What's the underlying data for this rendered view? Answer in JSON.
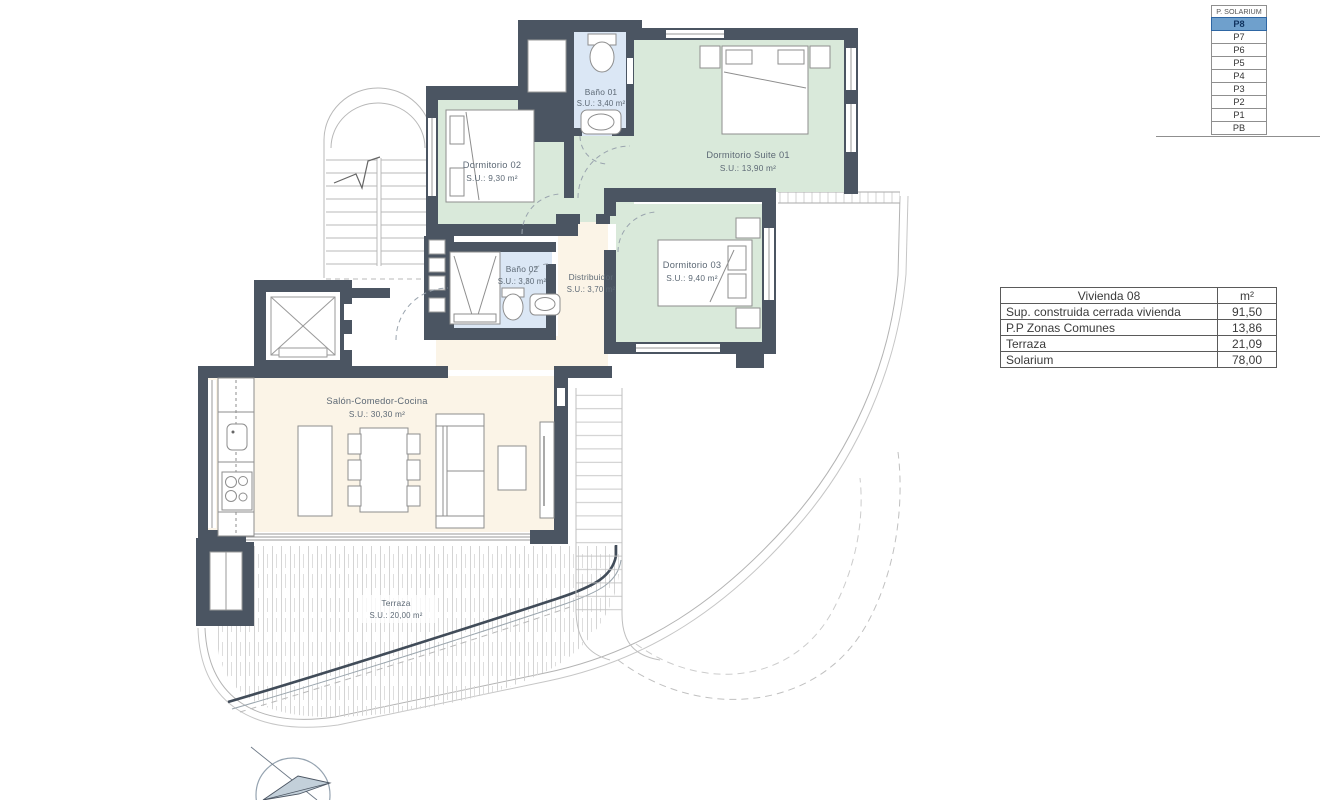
{
  "floor_selector": {
    "title": "P. SOLARIUM",
    "levels": [
      "P8",
      "P7",
      "P6",
      "P5",
      "P4",
      "P3",
      "P2",
      "P1",
      "PB"
    ],
    "selected": "P8",
    "highlight_color": "#6fa0cc"
  },
  "area_table": {
    "header": {
      "name": "Vivienda 08",
      "unit": "m²"
    },
    "rows": [
      {
        "label": "Sup. construida cerrada vivienda",
        "value": "91,50"
      },
      {
        "label": "P.P Zonas Comunes",
        "value": "13,86"
      },
      {
        "label": "Terraza",
        "value": "21,09"
      },
      {
        "label": "Solarium",
        "value": "78,00"
      }
    ]
  },
  "rooms": {
    "bano01": {
      "name": "Baño 01",
      "area": "S.U.: 3,40 m²"
    },
    "dorm02": {
      "name": "Dormitorio 02",
      "area": "S.U.: 9,30 m²"
    },
    "suite01": {
      "name": "Dormitorio Suite 01",
      "area": "S.U.: 13,90 m²"
    },
    "dorm03": {
      "name": "Dormitorio 03",
      "area": "S.U.: 9,40 m²"
    },
    "bano02": {
      "name": "Baño 02",
      "area": "S.U.: 3,30 m²"
    },
    "distribuidor": {
      "name": "Distribuidor",
      "area": "S.U.: 3,70 m²"
    },
    "salon": {
      "name": "Salón-Comedor-Cocina",
      "area": "S.U.: 30,30 m²"
    },
    "terraza": {
      "name": "Terraza",
      "area": "S.U.: 20,00 m²"
    }
  },
  "colors": {
    "wall": "#4b5562",
    "bedroom_fill": "#d9e9da",
    "bathroom_fill": "#dbe7f5",
    "living_fill": "#fbf4e7",
    "selected_floor": "#6fa0cc"
  }
}
